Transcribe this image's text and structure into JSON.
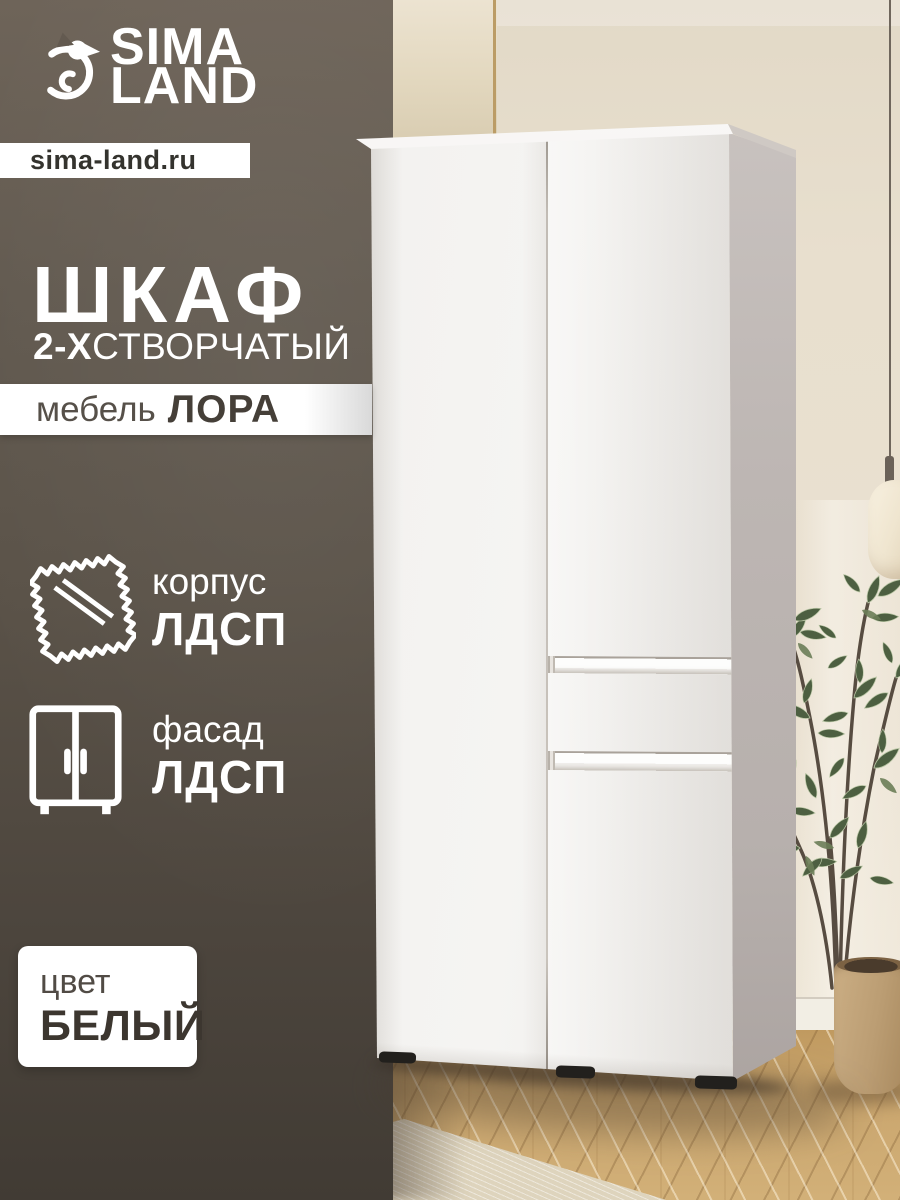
{
  "brand": {
    "name_line1": "SIMA",
    "name_line2": "LAND",
    "website": "sima-land.ru"
  },
  "product": {
    "title": "ШКАФ",
    "subtitle_prefix": "2-Х",
    "subtitle_rest": "СТВОРЧАТЫЙ",
    "series_label": "мебель",
    "series_name": "ЛОРА"
  },
  "features": [
    {
      "icon": "fabric-swatch-icon",
      "label": "корпус",
      "value": "ЛДСП"
    },
    {
      "icon": "wardrobe-icon",
      "label": "фасад",
      "value": "ЛДСП"
    }
  ],
  "color_card": {
    "label": "цвет",
    "value": "БЕЛЫЙ"
  },
  "colors": {
    "panel-top": "#6e6459",
    "panel-mid": "#5a5248",
    "panel-bottom": "#413b34",
    "wall": "#e8dfcd",
    "gold": "#bb9c66",
    "floor": "#c8a36c",
    "rug": "#ded4bd",
    "wardrobe-front": "#f2f1ef",
    "wardrobe-side": "#b7b0ad",
    "leaf": "#4d5f41",
    "stem": "#574c41",
    "pot": "#bb9d73",
    "lamp": "#efe5cf"
  }
}
